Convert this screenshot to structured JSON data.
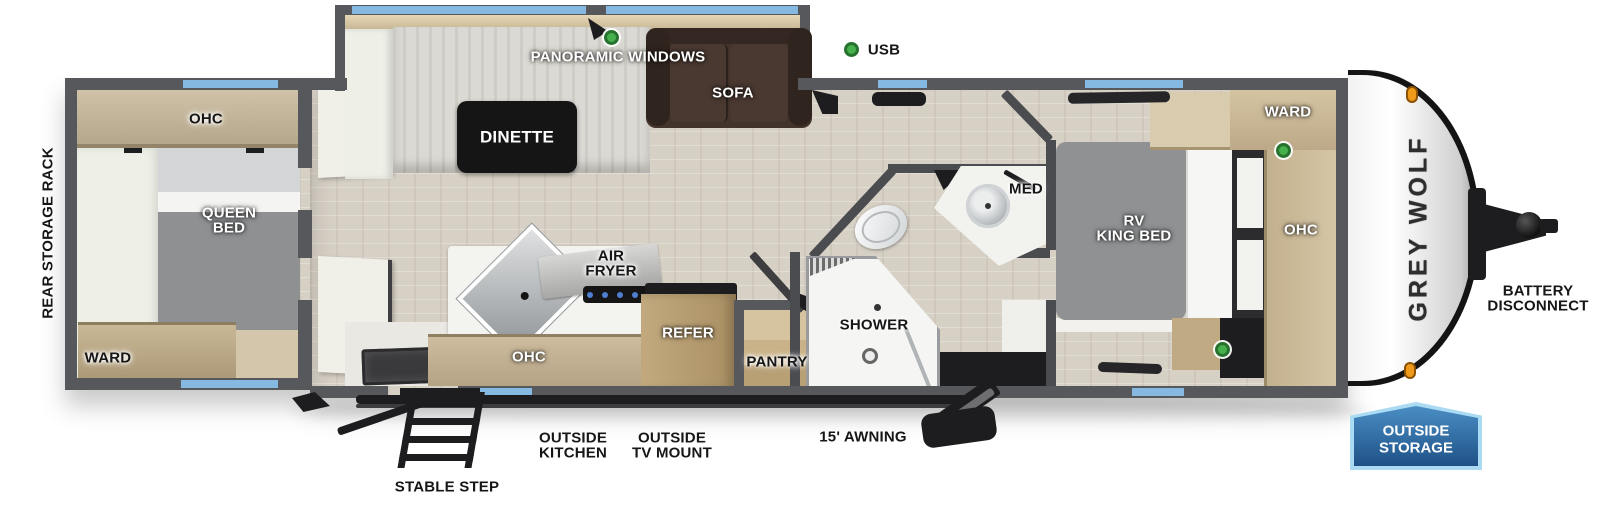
{
  "legend": {
    "panoramic_windows": "PANORAMIC WINDOWS",
    "usb": "USB"
  },
  "rear_bedroom": {
    "rack": "REAR STORAGE RACK",
    "ohc": "OHC",
    "bed": "QUEEN\nBED",
    "ward": "WARD"
  },
  "living": {
    "dinette": "DINETTE",
    "sofa": "SOFA"
  },
  "kitchen": {
    "air_fryer": "AIR\nFRYER",
    "ohc": "OHC",
    "refer": "REFER",
    "pantry": "PANTRY"
  },
  "bath": {
    "shower": "SHOWER",
    "med": "MED"
  },
  "front_bedroom": {
    "bed": "RV\nKING BED",
    "ward": "WARD",
    "ohc": "OHC"
  },
  "exterior": {
    "brand": "GREY WOLF",
    "battery": "BATTERY\nDISCONNECT",
    "outside_storage": "OUTSIDE\nSTORAGE",
    "outside_kitchen": "OUTSIDE\nKITCHEN",
    "outside_tv": "OUTSIDE\nTV MOUNT",
    "awning": "15' AWNING",
    "step": "STABLE STEP"
  },
  "colors": {
    "wall_gray": "#57585c",
    "window_blue": "#86b9e2",
    "accent_green": "#46b14c",
    "badge_blue": "#2a5f94",
    "floor_tan": "#d7d0c5"
  }
}
